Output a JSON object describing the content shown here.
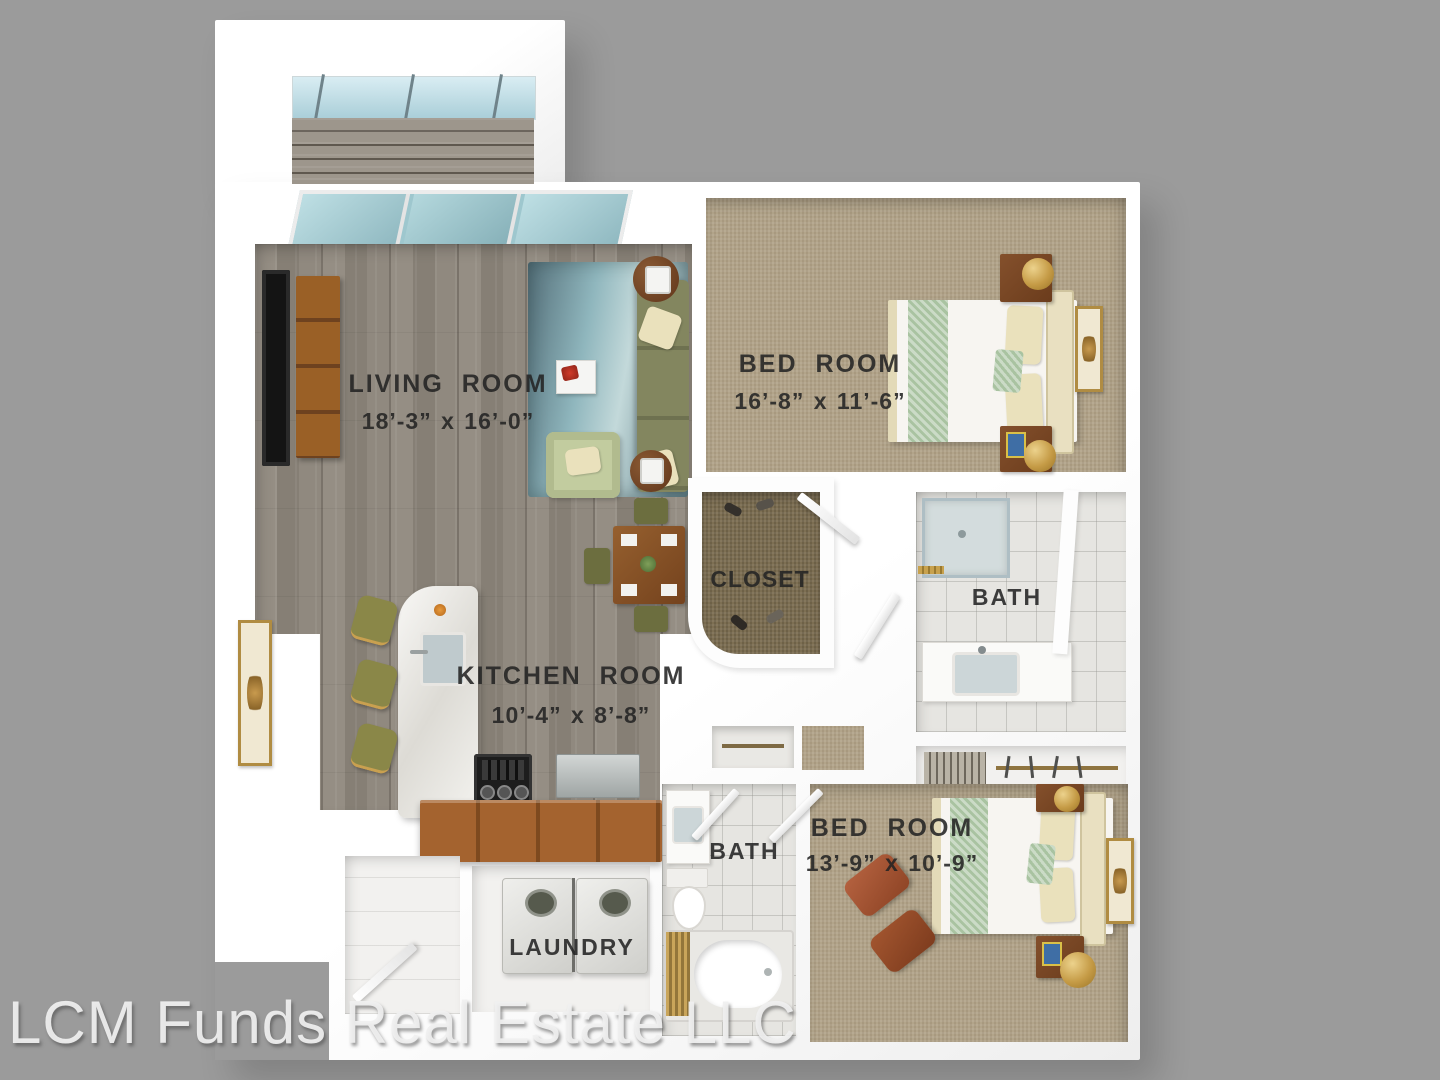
{
  "watermark": "LCM Funds Real Estate LLC",
  "rooms": {
    "living": {
      "label": "LIVING ROOM",
      "dims": "18’-3” x 16’-0”"
    },
    "bedroom1": {
      "label": "BED ROOM",
      "dims": "16’-8” x 11’-6”"
    },
    "closet": {
      "label": "CLOSET"
    },
    "bath1": {
      "label": "BATH"
    },
    "kitchen": {
      "label": "KITCHEN  ROOM",
      "dims": "10’-4” x 8’-8”"
    },
    "bath2": {
      "label": "BATH"
    },
    "bedroom2": {
      "label": "BED ROOM",
      "dims": "13’-9” x 10’-9”"
    },
    "laundry": {
      "label": "LAUNDRY"
    }
  },
  "palette": {
    "background": "#9b9b9b",
    "walls": "#ffffff",
    "wood_floor": "#8d867c",
    "carpet": "#b2a48a",
    "rug_teal": "#8fb6bd",
    "sofa_olive": "#7b7e5c",
    "cabinet_wood": "#9c5c2e",
    "bedding_green": "#a9c3a1",
    "lamp_gold": "#c59b46",
    "label_text": "#262626",
    "watermark_text": "#f0f0f0"
  }
}
